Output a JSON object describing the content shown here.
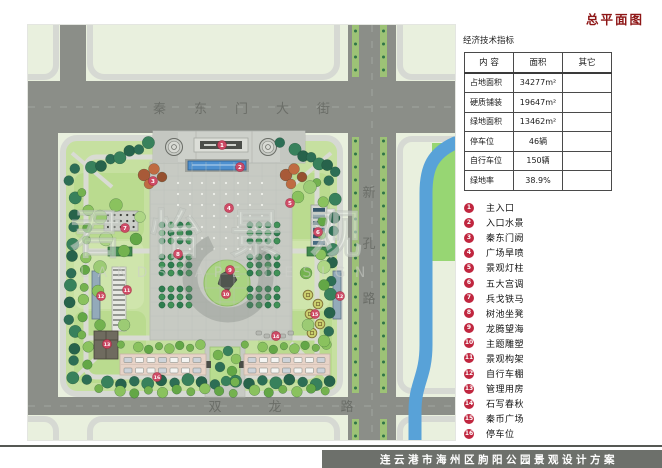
{
  "page": {
    "title": "总平面图"
  },
  "indicators": {
    "title": "经济技术指标",
    "headers": [
      "内 容",
      "面积",
      "其它"
    ],
    "rows": [
      [
        "占地面积",
        "34277m²",
        ""
      ],
      [
        "硬质铺装",
        "19647m²",
        ""
      ],
      [
        "绿地面积",
        "13462m²",
        ""
      ],
      [
        "停车位",
        "46辆",
        ""
      ],
      [
        "自行车位",
        "150辆",
        ""
      ],
      [
        "绿地率",
        "38.9%",
        ""
      ]
    ]
  },
  "legend": {
    "items": [
      {
        "num": "1",
        "label": "主入口"
      },
      {
        "num": "2",
        "label": "入口水景"
      },
      {
        "num": "3",
        "label": "秦东门阙"
      },
      {
        "num": "4",
        "label": "广场旱喷"
      },
      {
        "num": "5",
        "label": "景观灯柱"
      },
      {
        "num": "6",
        "label": "五大宫调"
      },
      {
        "num": "7",
        "label": "兵戈铁马"
      },
      {
        "num": "8",
        "label": "树池坐凳"
      },
      {
        "num": "9",
        "label": "龙腾望海"
      },
      {
        "num": "10",
        "label": "主题雕塑"
      },
      {
        "num": "11",
        "label": "景观构架"
      },
      {
        "num": "12",
        "label": "自行车棚"
      },
      {
        "num": "13",
        "label": "管理用房"
      },
      {
        "num": "14",
        "label": "石写春秋"
      },
      {
        "num": "15",
        "label": "秦币广场"
      },
      {
        "num": "16",
        "label": "停车位"
      }
    ]
  },
  "plan": {
    "road_top": "秦东门大街",
    "road_right": [
      "新",
      "孔",
      "路"
    ],
    "road_bottom": [
      "双",
      "龙",
      "路"
    ],
    "watermark_cn": "君怡景观",
    "watermark_en": "LANDSCAPE DESIGN"
  },
  "footer": {
    "title": "连云港市海州区朐阳公园景观设计方案"
  },
  "colors": {
    "accent_red": "#c0263f",
    "plan_marker_red": "#cf4663",
    "title_red": "#8e1616",
    "road_gray": "#8b8e88",
    "water_blue": "#58a2d8",
    "lawn_green": "#c6e0a0"
  }
}
